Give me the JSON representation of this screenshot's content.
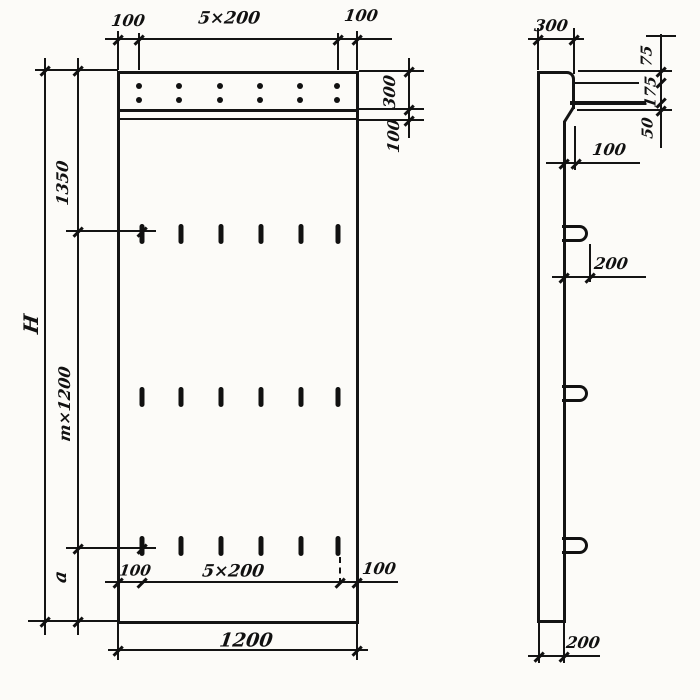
{
  "document": {
    "kind": "precast concrete panel working drawing, two orthographic views",
    "ink_color": "#141414",
    "paper_color": "#fcfbf8"
  },
  "front_view": {
    "top_dim": {
      "left": "100",
      "middle": "5×200",
      "right": "100"
    },
    "right_chain": {
      "top": "300",
      "bottom": "100"
    },
    "left_dims": {
      "overall": "H",
      "upper": "1350",
      "middle": "m×1200",
      "lower": "a"
    },
    "bottom_inner_dim": {
      "left": "100",
      "middle": "5×200",
      "right": "100"
    },
    "bottom_outer_dim": "1200",
    "anchor_dots": {
      "rows": 2,
      "cols": 6
    },
    "slot_marks": {
      "rows": 3,
      "cols": 6
    }
  },
  "side_view": {
    "top_dim": "300",
    "right_chain": {
      "top": "75",
      "middle": "175",
      "bottom": "50"
    },
    "ledge_dim": "100",
    "loop_dim": "200",
    "thickness_dim": "200",
    "loops": 3,
    "dowel_bars": 2
  }
}
